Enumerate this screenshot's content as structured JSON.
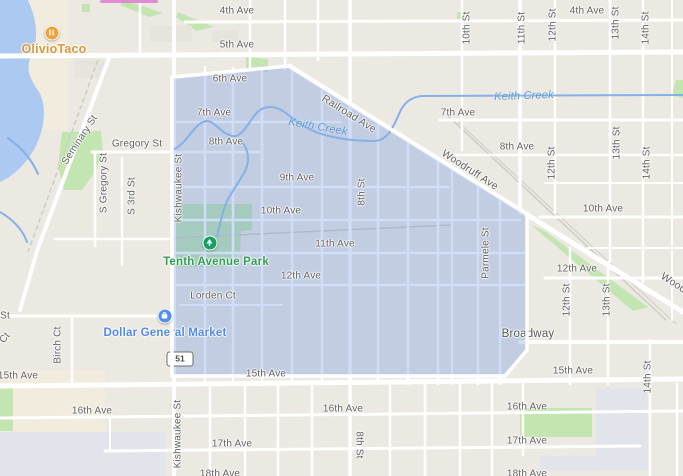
{
  "route": {
    "shield": "51"
  },
  "colors": {
    "region_fill": "#618de2",
    "region_border": "#ffffff",
    "water": "#abc9f1",
    "creek": "#84b1e8",
    "park_green": "#c3e5b1",
    "road": "#ffffff",
    "land": "#ece9e2",
    "street_label": "#616161",
    "water_label": "#5d9ad6",
    "poi_food": "#d6983a",
    "poi_park": "#2f9e52",
    "poi_shop": "#5088ee"
  },
  "labels": [
    {
      "text": "4th Ave",
      "x": 237,
      "y": 11,
      "kind": "st"
    },
    {
      "text": "4th Ave",
      "x": 587,
      "y": 11,
      "kind": "st"
    },
    {
      "text": "5th Ave",
      "x": 237,
      "y": 45,
      "kind": "st"
    },
    {
      "text": "6th Ave",
      "x": 230,
      "y": 79,
      "kind": "st"
    },
    {
      "text": "7th Ave",
      "x": 214,
      "y": 113,
      "kind": "st"
    },
    {
      "text": "7th Ave",
      "x": 458,
      "y": 113,
      "kind": "st"
    },
    {
      "text": "8th Ave",
      "x": 226,
      "y": 142,
      "kind": "st"
    },
    {
      "text": "8th Ave",
      "x": 517,
      "y": 147,
      "kind": "st"
    },
    {
      "text": "9th Ave",
      "x": 297,
      "y": 178,
      "kind": "st"
    },
    {
      "text": "10th Ave",
      "x": 281,
      "y": 211,
      "kind": "st"
    },
    {
      "text": "10th Ave",
      "x": 603,
      "y": 209,
      "kind": "st"
    },
    {
      "text": "11th Ave",
      "x": 335,
      "y": 244,
      "kind": "st"
    },
    {
      "text": "12th Ave",
      "x": 301,
      "y": 276,
      "kind": "st"
    },
    {
      "text": "12th Ave",
      "x": 577,
      "y": 269,
      "kind": "st"
    },
    {
      "text": "Lorden Ct",
      "x": 213,
      "y": 296,
      "kind": "st"
    },
    {
      "text": "Broadway",
      "x": 528,
      "y": 334,
      "kind": "stl",
      "layer": "under"
    },
    {
      "text": "15th Ave",
      "x": 266,
      "y": 374,
      "kind": "st"
    },
    {
      "text": "15th Ave",
      "x": 573,
      "y": 371,
      "kind": "st"
    },
    {
      "text": "15th Ave",
      "x": 18,
      "y": 376,
      "kind": "st"
    },
    {
      "text": "16th Ave",
      "x": 92,
      "y": 411,
      "kind": "st"
    },
    {
      "text": "16th Ave",
      "x": 343,
      "y": 409,
      "kind": "st"
    },
    {
      "text": "16th Ave",
      "x": 527,
      "y": 407,
      "kind": "st"
    },
    {
      "text": "17th Ave",
      "x": 232,
      "y": 444,
      "kind": "st"
    },
    {
      "text": "17th Ave",
      "x": 527,
      "y": 441,
      "kind": "st"
    },
    {
      "text": "18th Ave",
      "x": 220,
      "y": 474,
      "kind": "st"
    },
    {
      "text": "18th Ave",
      "x": 527,
      "y": 474,
      "kind": "st"
    },
    {
      "text": "Gregory St",
      "x": 137,
      "y": 144,
      "kind": "st"
    },
    {
      "text": "St",
      "x": 5,
      "y": 316,
      "kind": "st"
    },
    {
      "text": "Seminary St",
      "x": 80,
      "y": 140,
      "rot": -57,
      "kind": "stv"
    },
    {
      "text": "S Gregory St",
      "x": 104,
      "y": 183,
      "rot": -90,
      "kind": "stv"
    },
    {
      "text": "S 3rd St",
      "x": 132,
      "y": 196,
      "rot": -90,
      "kind": "stv"
    },
    {
      "text": "Kishwaukee St",
      "x": 179,
      "y": 188,
      "rot": -90,
      "kind": "stv"
    },
    {
      "text": "Kishwaukee St",
      "x": 178,
      "y": 434,
      "rot": -90,
      "kind": "stv"
    },
    {
      "text": "8th St",
      "x": 362,
      "y": 192,
      "rot": -90,
      "kind": "stv"
    },
    {
      "text": "8th St",
      "x": 359,
      "y": 445,
      "rot": 90,
      "kind": "stv"
    },
    {
      "text": "Parmele St",
      "x": 486,
      "y": 253,
      "rot": -90,
      "kind": "stv"
    },
    {
      "text": "10th St",
      "x": 467,
      "y": 28,
      "rot": -90,
      "kind": "stv"
    },
    {
      "text": "11th St",
      "x": 522,
      "y": 28,
      "rot": -90,
      "kind": "stv"
    },
    {
      "text": "12th St",
      "x": 553,
      "y": 25,
      "rot": -90,
      "kind": "stv"
    },
    {
      "text": "13th St",
      "x": 616,
      "y": 23,
      "rot": -90,
      "kind": "stv"
    },
    {
      "text": "14th St",
      "x": 646,
      "y": 28,
      "rot": -90,
      "kind": "stv"
    },
    {
      "text": "12th St",
      "x": 552,
      "y": 163,
      "rot": -90,
      "kind": "stv"
    },
    {
      "text": "13th St",
      "x": 617,
      "y": 143,
      "rot": -90,
      "kind": "stv"
    },
    {
      "text": "14th St",
      "x": 647,
      "y": 163,
      "rot": -90,
      "kind": "stv"
    },
    {
      "text": "12th St",
      "x": 567,
      "y": 300,
      "rot": -90,
      "kind": "stv"
    },
    {
      "text": "13th St",
      "x": 607,
      "y": 300,
      "rot": -90,
      "kind": "stv"
    },
    {
      "text": "14th St",
      "x": 648,
      "y": 377,
      "rot": -90,
      "kind": "stv"
    },
    {
      "text": "Birch Ct",
      "x": 58,
      "y": 345,
      "rot": -90,
      "kind": "stv"
    },
    {
      "text": "Ct",
      "x": 5,
      "y": 338,
      "rot": -50,
      "kind": "stv"
    },
    {
      "text": "Railroad Ave",
      "x": 349,
      "y": 114,
      "rot": 32,
      "kind": "diag"
    },
    {
      "text": "Woodruff Ave",
      "x": 470,
      "y": 170,
      "rot": 33,
      "kind": "diag"
    },
    {
      "text": "Woodruff Ave",
      "x": 689,
      "y": 293,
      "rot": 33,
      "kind": "diag"
    },
    {
      "text": "Keith Creek",
      "x": 318,
      "y": 127,
      "rot": 10,
      "kind": "water"
    },
    {
      "text": "Keith Creek",
      "x": 524,
      "y": 96,
      "rot": -2,
      "kind": "water"
    },
    {
      "text": "OlivioTaco",
      "x": 54,
      "y": 49,
      "kind": "food"
    },
    {
      "text": "Tenth Avenue Park",
      "x": 216,
      "y": 262,
      "kind": "park"
    },
    {
      "text": "Dollar General Market",
      "x": 165,
      "y": 333,
      "kind": "shop",
      "layer": "under"
    }
  ]
}
